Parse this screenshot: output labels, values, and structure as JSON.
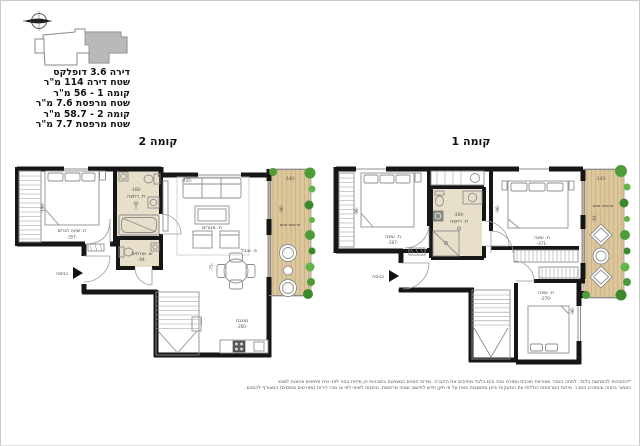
{
  "header": {
    "lines": [
      "דירה 3.6 דופלקס",
      "שטח דירה 114 מ\"ר",
      "קומה 1 - 56 מ\"ר",
      "שטח מרפסת 7.6 מ\"ר",
      "קומה 2 - 58.7 מ\"ר",
      "שטח מרפסת 7.7 מ\"ר"
    ]
  },
  "plans": {
    "floor2": {
      "title": "קומה 2",
      "labels": {
        "master_bedroom": "ח. שינה הורים",
        "master_bedroom_dim": "-357-",
        "master_bedroom_side_dim": "-190-",
        "bathroom": "ת. רחצה",
        "bathroom_dim": "-168-",
        "guest_wc": "ש. אורחים",
        "guest_wc_dim": "-94-",
        "living": "ח. מגורים",
        "living_dim": "-415-",
        "dining": "פ. אוכל",
        "dining_dim": "-75-",
        "kitchen": "מטבח",
        "kitchen_dim": "-260-",
        "balcony": "מרפסת שמש",
        "balcony_dim_top": "-140-",
        "balcony_dim_side": "-90-",
        "entry": "כניסה"
      }
    },
    "floor1": {
      "title": "קומה 1",
      "labels": {
        "bedroom1": "ח. שינה",
        "bedroom1_dim": "-267-",
        "bedroom1_side_dim": "-90-",
        "bathroom": "ת. רחצה",
        "bathroom_dim": "-204-",
        "bedroom2": "ח. שינה",
        "bedroom2_dim": "-371-",
        "bedroom2_side_dim": "-90-",
        "bedroom3": "ח. שינה",
        "bedroom3_dim": "-270-",
        "bedroom3_side_dim": "-90-",
        "balcony": "מרפסת שמש",
        "balcony_dim_top": "-143-",
        "balcony_dim_side": "-91-",
        "entry": "כניסה"
      }
    }
  },
  "footer": {
    "line1": "*התוכניות להמחשה בלבד. לחוזה המכר מצורפת תוכנית ומפרט טכני והם בלבד מחייבים את החברה. מידות הפנים המצוינות בתוכניות הן מידות בניה לפני טיח וחיפויים וניתנות לשינוי",
    "line2": "כאמור בחוזה ובמפרט המכר. מידות המרפסות כוללות את המעקות והינן מחושבות וזאת על פי תקן חדש לחישוב שטחי מרפסות, וניתנות לשינוי לפי צו מכר דירות (מפרטים וטפסים) המצורף להסכם."
  },
  "colors": {
    "wall": "#161616",
    "wet_room_floor": "#e7dfc9",
    "deck_wood": "#dcc69c",
    "plant_green": "#4e9c38",
    "key_plan_fill": "#b9b9b9"
  }
}
